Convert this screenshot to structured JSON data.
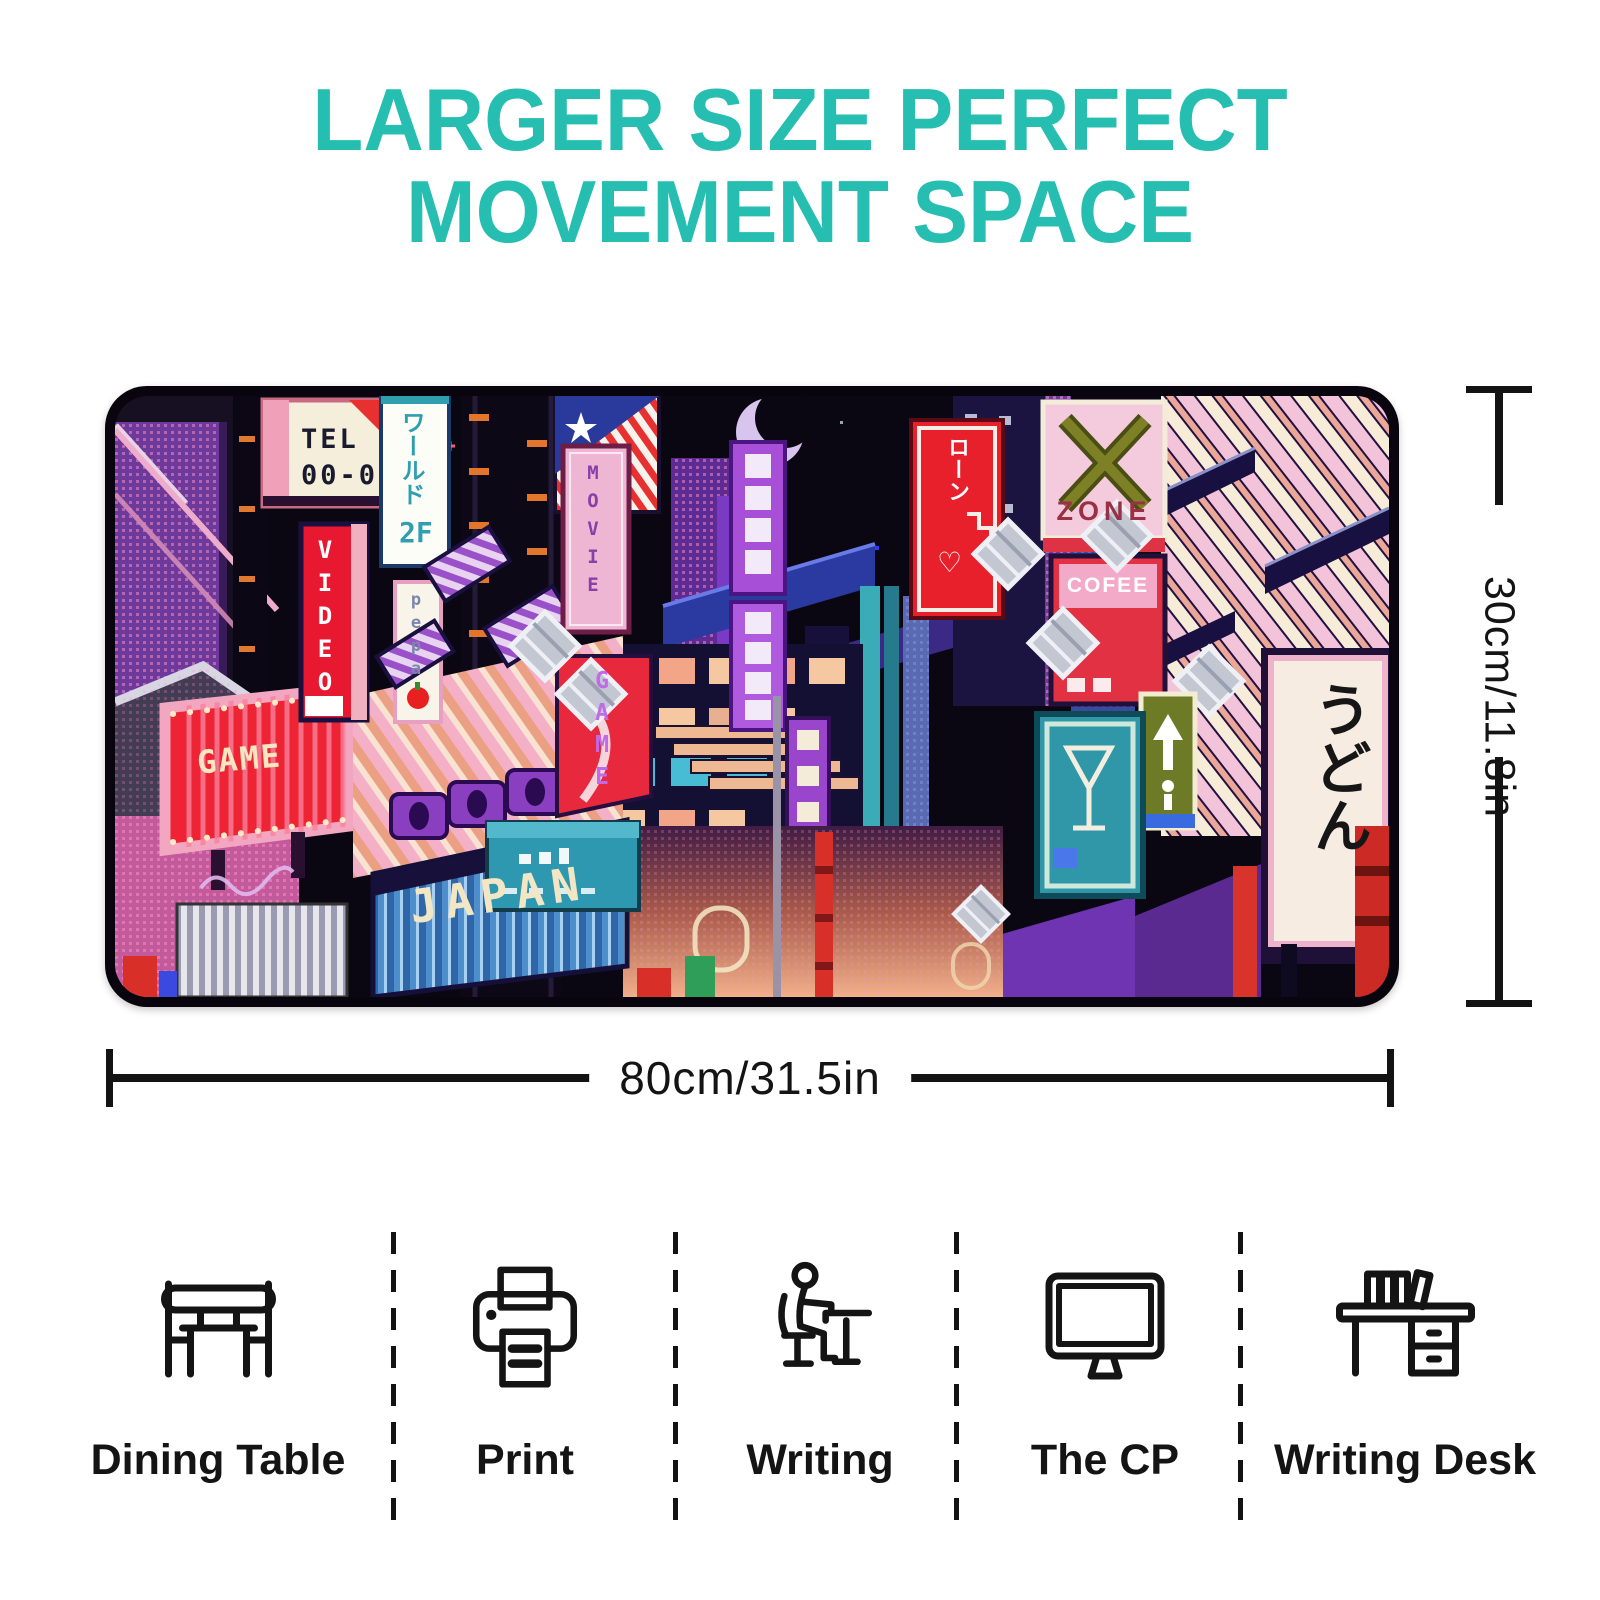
{
  "title": {
    "line1": "LARGER SIZE PERFECT",
    "line2": "MOVEMENT SPACE"
  },
  "colors": {
    "accent": "#25beb1",
    "ink": "#141414",
    "pad_rim": "#08050e"
  },
  "pad": {
    "signs": {
      "tel_line1": "TEL",
      "tel_line2": "00-0",
      "world_vertical": "ワールド",
      "world_floor": "2F",
      "video": "VIDEO",
      "pepa": "pepa",
      "movie": "MOVIE",
      "game_vertical": "GAME",
      "game_marquee": "GAME",
      "japan": "JAPAN",
      "loan_vertical": "ローン",
      "loan_heart": "♡",
      "zone": "ZONE",
      "coffee": "COFEE",
      "udon_vertical": "うどん"
    }
  },
  "dimensions": {
    "height_label": "30cm/11.8in",
    "width_label": "80cm/31.5in"
  },
  "features": [
    {
      "icon": "dining-table-icon",
      "label": "Dining Table"
    },
    {
      "icon": "printer-icon",
      "label": "Print"
    },
    {
      "icon": "writing-icon",
      "label": "Writing"
    },
    {
      "icon": "computer-icon",
      "label": "The CP"
    },
    {
      "icon": "writing-desk-icon",
      "label": "Writing Desk"
    }
  ]
}
